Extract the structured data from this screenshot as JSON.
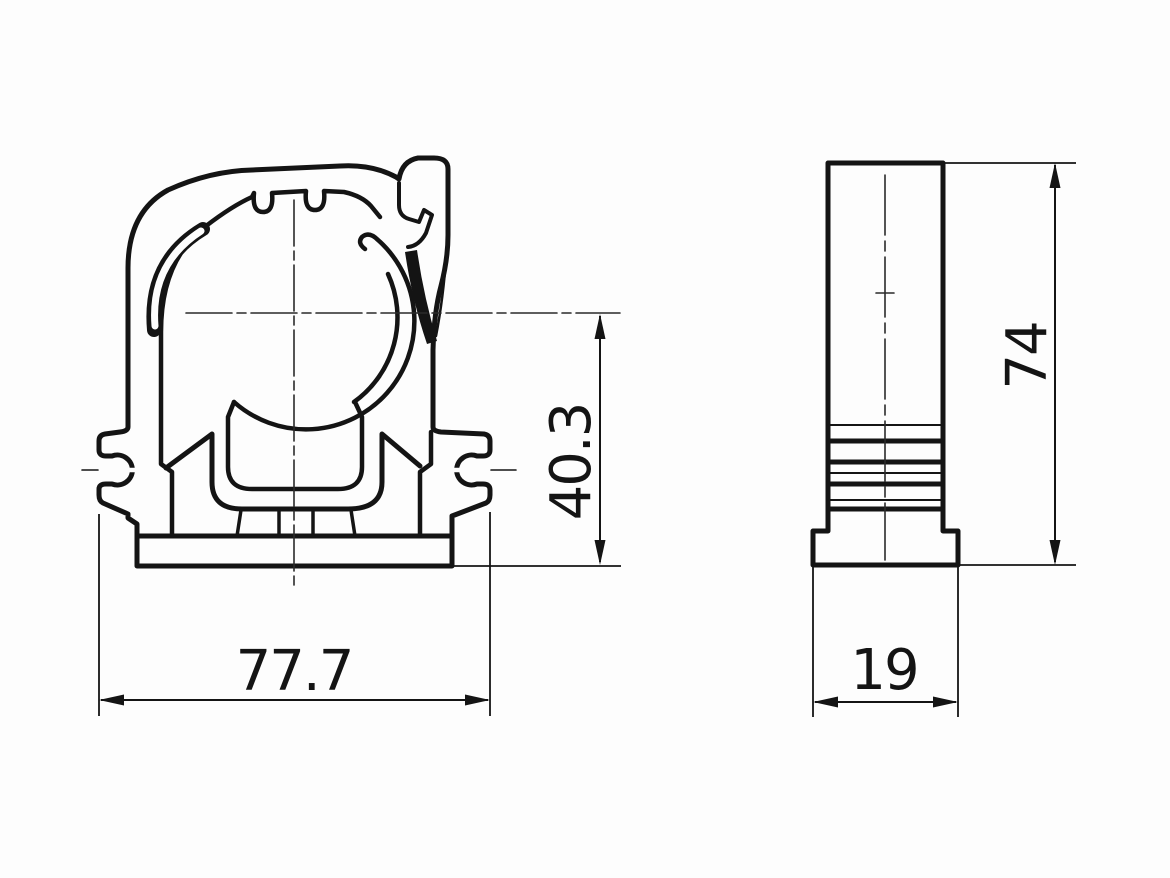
{
  "colors": {
    "line": "#141414",
    "centerline": "#2a2a2a",
    "background": "#fdfdfd"
  },
  "dimensions": {
    "front_width": {
      "value": "77.7"
    },
    "front_height": {
      "value": "40.3"
    },
    "side_height": {
      "value": "74"
    },
    "side_width": {
      "value": "19"
    }
  }
}
